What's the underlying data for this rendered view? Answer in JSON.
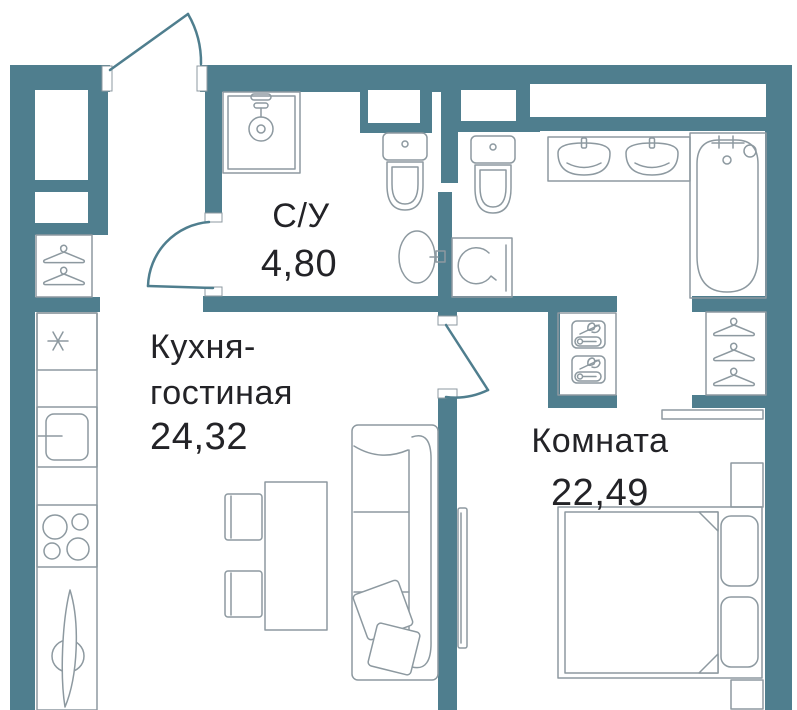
{
  "title": "Apartment floor plan",
  "colors": {
    "wall": "#4f7e8e",
    "outline": "#8d99a0",
    "text": "#232327",
    "paper": "#ffffff"
  },
  "rooms": {
    "bathroom": {
      "name": "С/У",
      "area": "4,80"
    },
    "kitchen_living": {
      "name_line1": "Кухня-",
      "name_line2": "гостиная",
      "area": "24,32"
    },
    "bedroom": {
      "name": "Комната",
      "area": "22,49"
    }
  },
  "icons": [
    "entry-door-arc",
    "coat-hanger",
    "shower-cabin",
    "toilet",
    "wall-sink",
    "washing-machine",
    "vanity-double-sink",
    "bathtub",
    "towel-shelf",
    "wardrobe-hangers",
    "fridge-snowflake",
    "oven",
    "cooktop-burners",
    "kitchen-sink",
    "dining-table",
    "chair",
    "sofa",
    "throw-pillow",
    "tv",
    "bed",
    "bed-pillow",
    "nightstand",
    "console-shelf"
  ]
}
